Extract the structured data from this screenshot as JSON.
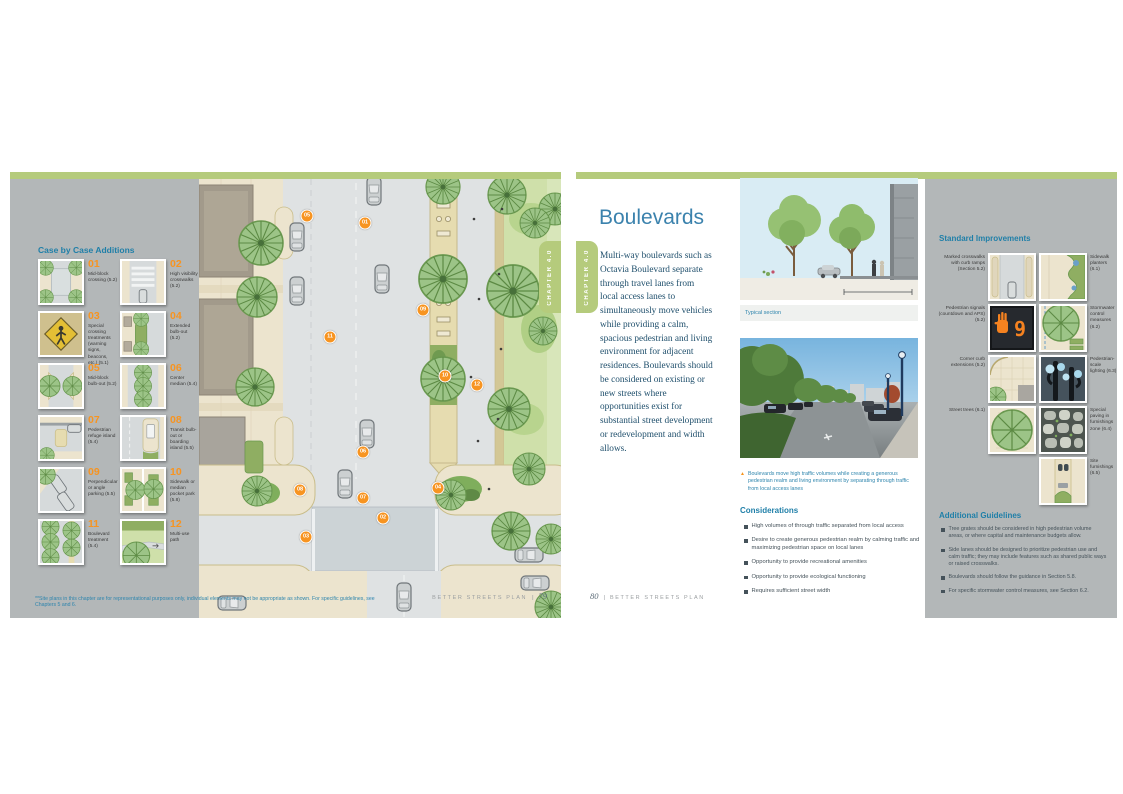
{
  "chapter_tab": "CHAPTER 4.0",
  "colors": {
    "accent_orange": "#f79421",
    "tab_green": "#b5cb7c",
    "heading_blue": "#1f7fa8",
    "panel_gray": "#b3b7b8"
  },
  "left_page": {
    "legend_title": "Case by Case Additions",
    "legend": [
      {
        "num": "01",
        "label": "Mid-block crossing (5.2)",
        "thumb": "crossing"
      },
      {
        "num": "02",
        "label": "High visibility crosswalks (5.2)",
        "thumb": "crosswalk"
      },
      {
        "num": "03",
        "label": "Special crossing treatments (warning signs, beacons, etc.) (5.1)",
        "thumb": "warning"
      },
      {
        "num": "04",
        "label": "Extended bulb-out (5.2)",
        "thumb": "bulbout"
      },
      {
        "num": "05",
        "label": "Mid-block bulb-out (5.2)",
        "thumb": "midblock"
      },
      {
        "num": "06",
        "label": "Center median (5.4)",
        "thumb": "median"
      },
      {
        "num": "07",
        "label": "Pedestrian refuge island (5.4)",
        "thumb": "refuge"
      },
      {
        "num": "08",
        "label": "Transit bulb-out or boarding island (5.5)",
        "thumb": "transit"
      },
      {
        "num": "09",
        "label": "Perpendicular or angle parking (5.5)",
        "thumb": "parking"
      },
      {
        "num": "10",
        "label": "Sidewalk or median pocket park (5.8)",
        "thumb": "pocketpark"
      },
      {
        "num": "11",
        "label": "Boulevard treatment (5.4)",
        "thumb": "boulevard"
      },
      {
        "num": "12",
        "label": "Multi-use path",
        "thumb": "path"
      }
    ],
    "plan_markers": [
      {
        "num": "05",
        "x": 108,
        "y": 37
      },
      {
        "num": "01",
        "x": 166,
        "y": 44
      },
      {
        "num": "11",
        "x": 131,
        "y": 158
      },
      {
        "num": "09",
        "x": 224,
        "y": 131
      },
      {
        "num": "10",
        "x": 246,
        "y": 197
      },
      {
        "num": "12",
        "x": 278,
        "y": 206
      },
      {
        "num": "06",
        "x": 164,
        "y": 273
      },
      {
        "num": "07",
        "x": 164,
        "y": 319
      },
      {
        "num": "02",
        "x": 184,
        "y": 339
      },
      {
        "num": "08",
        "x": 101,
        "y": 311
      },
      {
        "num": "03",
        "x": 107,
        "y": 358
      },
      {
        "num": "04",
        "x": 239,
        "y": 309
      }
    ],
    "footnote": "**Site plans in this chapter are for representational purposes only, individual elements may not be appropriate as shown. For specific guidelines, see Chapters 5 and 6.",
    "footer": {
      "brand": "BETTER STREETS PLAN",
      "page": "79"
    }
  },
  "right_page": {
    "title": "Boulevards",
    "intro": "Multi-way boulevards such as Octavia Boulevard separate through travel lanes from local access lanes to simultaneously move vehicles while providing a calm, spacious pedestrian and living environment for adjacent residences. Boulevards should be considered on existing or new streets where opportunities exist for substantial street development or redevelopment and width allows.",
    "section_caption": "Typical section",
    "photo_caption": "Boulevards move high traffic volumes while creating a generous pedestrian realm and living environment by separating through traffic from local access lanes",
    "considerations_title": "Considerations",
    "considerations_items": [
      "High volumes of through traffic separated from local access",
      "Desire to create generous pedestrian realm by calming traffic and maximizing pedestrian space on local lanes",
      "Opportunity to provide recreational amenities",
      "Opportunity to provide ecological functioning",
      "Requires sufficient street width"
    ],
    "sidebar": {
      "improvements_title": "Standard Improvements",
      "improvements": [
        {
          "label": "Marked crosswalks with curb ramps (Section 5.2)",
          "side": "left",
          "thumb": "s_cross"
        },
        {
          "label": "Sidewalk planters (6.1)",
          "side": "right",
          "thumb": "s_planter"
        },
        {
          "label": "Pedestrian signals (countdown and APS) (5.2)",
          "side": "left",
          "thumb": "s_signal"
        },
        {
          "label": "Stormwater control measures (6.2)",
          "side": "right",
          "thumb": "s_storm"
        },
        {
          "label": "Corner curb extensions (5.2)",
          "side": "left",
          "thumb": "s_corner"
        },
        {
          "label": "Pedestrian-scale lighting (6.3)",
          "side": "right",
          "thumb": "s_light"
        },
        {
          "label": "Street trees (6.1)",
          "side": "left",
          "thumb": "s_tree"
        },
        {
          "label": "Special paving in furnishings zone (6.4)",
          "side": "right",
          "thumb": "s_paving"
        },
        {
          "label": "Site furnishings (6.5)",
          "side": "right",
          "thumb": "s_furn"
        }
      ],
      "guidelines_title": "Additional Guidelines",
      "guidelines": [
        "Tree grates should be considered in high pedestrian volume areas, or where capital and maintenance budgets allow.",
        "Side lanes should be designed to prioritize pedestrian use and calm traffic; they may include features such as shared public ways or raised crosswalks.",
        "Boulevards should follow the guidance in Section 5.8.",
        "For specific stormwater control measures, see Section 6.2."
      ]
    },
    "footer": {
      "page": "80",
      "brand": "BETTER STREETS PLAN"
    }
  }
}
